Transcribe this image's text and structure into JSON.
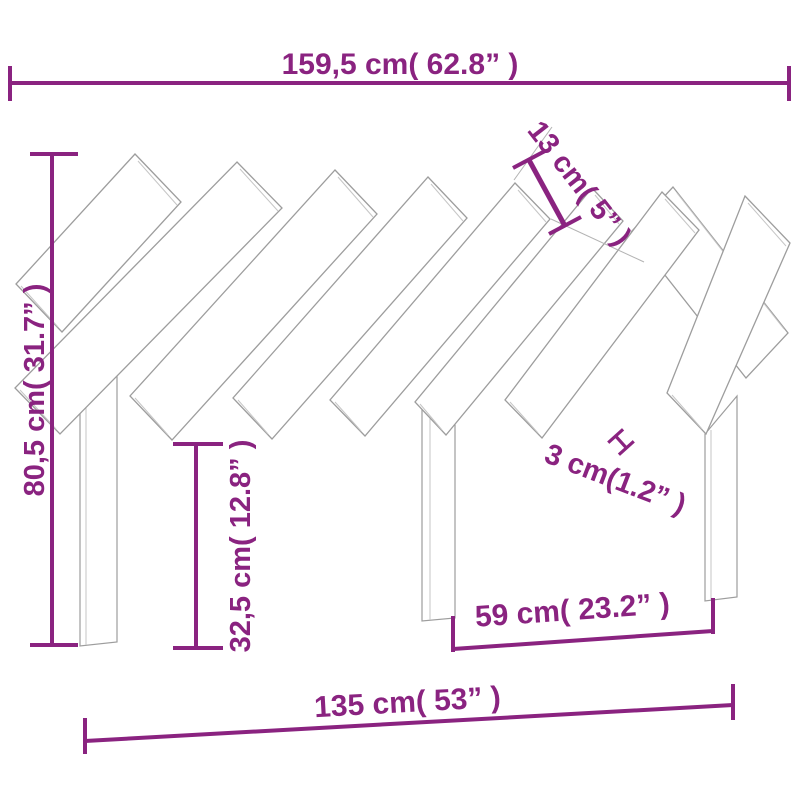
{
  "diagram": {
    "kind": "product-dimension-diagram",
    "subject": "bed-headboard-with-diagonal-slats",
    "colors": {
      "dimension": "#8a2380",
      "outline": "#9d9d9d",
      "outline_light": "#c6c6c6",
      "background": "#ffffff"
    },
    "measurements": {
      "overall_width": {
        "label": "159,5 cm( 62.8” )"
      },
      "slat_width": {
        "label": "13 cm( 5” )"
      },
      "overall_height": {
        "label": "80,5 cm( 31.7” )"
      },
      "slat_gap": {
        "label": "3 cm(1.2” )"
      },
      "leg_height": {
        "label": "32,5 cm( 12.8” )"
      },
      "leg_spacing": {
        "label": "59 cm( 23.2” )"
      },
      "base_width": {
        "label": "135 cm( 53” )"
      }
    }
  }
}
